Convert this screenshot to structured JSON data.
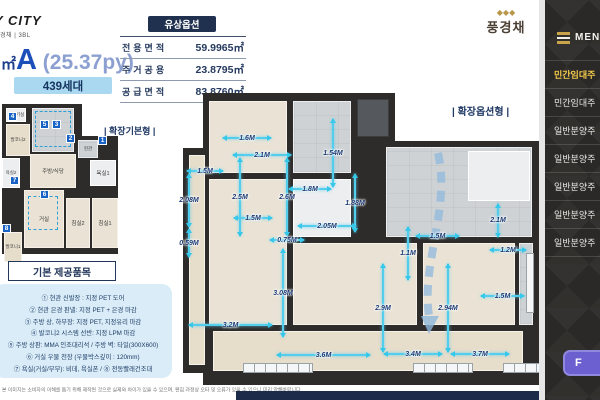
{
  "logo": {
    "brand": "Y CITY",
    "sub": "풍경채 | 3BL"
  },
  "brand_right": {
    "emblem": "◆◆◆",
    "name": "풍경채"
  },
  "header": {
    "unit_area_prefix": "㎡",
    "unit_type": "A",
    "unit_py": " (25.37py)",
    "units_badge": "439세대",
    "option_badge": "유상옵션",
    "area_table": [
      {
        "label": "전용면적",
        "value": "59.9965㎡"
      },
      {
        "label": "주거공용",
        "value": "23.8795㎡"
      },
      {
        "label": "공급면적",
        "value": "83.8760㎡"
      }
    ]
  },
  "plans": {
    "left_label": "| 확장기본형 |",
    "right_label": "| 확장옵션형 |",
    "left_rooms": [
      {
        "name": "실외기실",
        "x": 4,
        "y": 8,
        "w": 20,
        "h": 14,
        "cls": "white r-xs"
      },
      {
        "name": "발코니2",
        "x": 4,
        "y": 24,
        "w": 24,
        "h": 32,
        "cls": "beige2 r-xs"
      },
      {
        "name": "",
        "x": 30,
        "y": 8,
        "w": 42,
        "h": 44,
        "cls": "gray"
      },
      {
        "name": "",
        "x": 33,
        "y": 11,
        "w": 36,
        "h": 36,
        "cls": "dashed"
      },
      {
        "name": "주방/식당",
        "x": 28,
        "y": 54,
        "w": 46,
        "h": 34,
        "cls": "beige r-s"
      },
      {
        "name": "현관",
        "x": 76,
        "y": 40,
        "w": 20,
        "h": 18,
        "cls": "gray r-xs"
      },
      {
        "name": "욕실1",
        "x": 88,
        "y": 60,
        "w": 26,
        "h": 26,
        "cls": "white r-s"
      },
      {
        "name": "욕실2",
        "x": 0,
        "y": 58,
        "w": 18,
        "h": 30,
        "cls": "white r-xs"
      },
      {
        "name": "거실",
        "x": 22,
        "y": 90,
        "w": 40,
        "h": 58,
        "cls": "beige r-s"
      },
      {
        "name": "",
        "x": 26,
        "y": 96,
        "w": 30,
        "h": 34,
        "cls": "dashed"
      },
      {
        "name": "침실2",
        "x": 64,
        "y": 98,
        "w": 24,
        "h": 50,
        "cls": "beige r-s"
      },
      {
        "name": "침실1",
        "x": 90,
        "y": 98,
        "w": 26,
        "h": 50,
        "cls": "beige r-s"
      },
      {
        "name": "발코니1",
        "x": 2,
        "y": 132,
        "w": 18,
        "h": 30,
        "cls": "beige2 r-xs"
      }
    ],
    "left_badges": [
      {
        "n": "1",
        "x": 96,
        "y": 36
      },
      {
        "n": "2",
        "x": 64,
        "y": 34
      },
      {
        "n": "3",
        "x": 50,
        "y": 20
      },
      {
        "n": "4",
        "x": 6,
        "y": 12
      },
      {
        "n": "5",
        "x": 38,
        "y": 20
      },
      {
        "n": "6",
        "x": 38,
        "y": 90
      },
      {
        "n": "7",
        "x": 8,
        "y": 76
      },
      {
        "n": "8",
        "x": 0,
        "y": 124
      }
    ],
    "right_rooms": [
      {
        "x": 26,
        "y": 8,
        "w": 78,
        "h": 72,
        "cls": "beige"
      },
      {
        "x": 110,
        "y": 8,
        "w": 58,
        "h": 72,
        "cls": "gray"
      },
      {
        "x": 174,
        "y": 6,
        "w": 32,
        "h": 38,
        "cls": "dark2"
      },
      {
        "x": 26,
        "y": 86,
        "w": 78,
        "h": 146,
        "cls": "beige"
      },
      {
        "x": 110,
        "y": 86,
        "w": 58,
        "h": 58,
        "cls": "white"
      },
      {
        "x": 203,
        "y": 54,
        "w": 146,
        "h": 90,
        "cls": "gray"
      },
      {
        "x": 285,
        "y": 58,
        "w": 62,
        "h": 50,
        "cls": "white"
      },
      {
        "x": 110,
        "y": 150,
        "w": 124,
        "h": 82,
        "cls": "beige"
      },
      {
        "x": 240,
        "y": 150,
        "w": 92,
        "h": 82,
        "cls": "beige"
      },
      {
        "x": 336,
        "y": 150,
        "w": 14,
        "h": 82,
        "cls": "gray"
      },
      {
        "x": 30,
        "y": 238,
        "w": 310,
        "h": 40,
        "cls": "beige2"
      },
      {
        "x": 6,
        "y": 62,
        "w": 16,
        "h": 210,
        "cls": "beige2"
      },
      {
        "x": 60,
        "y": 270,
        "w": 70,
        "h": 10,
        "cls": "window"
      },
      {
        "x": 230,
        "y": 270,
        "w": 60,
        "h": 10,
        "cls": "window"
      },
      {
        "x": 320,
        "y": 270,
        "w": 40,
        "h": 10,
        "cls": "window"
      },
      {
        "x": 343,
        "y": 160,
        "w": 8,
        "h": 60,
        "cls": "window"
      }
    ],
    "right_dims": [
      {
        "label": "1.6M",
        "x": 39,
        "y": 39,
        "w": 50,
        "h": 12,
        "cls": "h"
      },
      {
        "label": "2.1M",
        "x": 49,
        "y": 56,
        "w": 60,
        "h": 12,
        "cls": "h"
      },
      {
        "label": "1.54M",
        "x": 144,
        "y": 25,
        "w": 12,
        "h": 70,
        "cls": "v"
      },
      {
        "label": "1.5M",
        "x": 3,
        "y": 72,
        "w": 38,
        "h": 12,
        "cls": "h"
      },
      {
        "label": "2.08M",
        "x": 0,
        "y": 80,
        "w": 12,
        "h": 55,
        "cls": "v"
      },
      {
        "label": "0.59M",
        "x": 0,
        "y": 135,
        "w": 12,
        "h": 30,
        "cls": "v"
      },
      {
        "label": "2.5M",
        "x": 51,
        "y": 64,
        "w": 12,
        "h": 80,
        "cls": "v"
      },
      {
        "label": "2.6M",
        "x": 98,
        "y": 64,
        "w": 12,
        "h": 80,
        "cls": "v"
      },
      {
        "label": "1.8M",
        "x": 105,
        "y": 90,
        "w": 44,
        "h": 12,
        "cls": "h"
      },
      {
        "label": "1.5M",
        "x": 50,
        "y": 119,
        "w": 40,
        "h": 12,
        "cls": "h"
      },
      {
        "label": "1.88M",
        "x": 166,
        "y": 80,
        "w": 12,
        "h": 60,
        "cls": "v"
      },
      {
        "label": "2.05M",
        "x": 114,
        "y": 127,
        "w": 60,
        "h": 12,
        "cls": "h"
      },
      {
        "label": "0.75M",
        "x": 86,
        "y": 141,
        "w": 36,
        "h": 12,
        "cls": "h"
      },
      {
        "label": "3.08M",
        "x": 94,
        "y": 155,
        "w": 12,
        "h": 90,
        "cls": "v"
      },
      {
        "label": "3.2M",
        "x": 5,
        "y": 226,
        "w": 85,
        "h": 12,
        "cls": "h"
      },
      {
        "label": "3.6M",
        "x": 93,
        "y": 256,
        "w": 95,
        "h": 12,
        "cls": "h"
      },
      {
        "label": "1.2M",
        "x": 306,
        "y": 151,
        "w": 38,
        "h": 12,
        "cls": "h"
      },
      {
        "label": "1.1M",
        "x": 219,
        "y": 133,
        "w": 12,
        "h": 55,
        "cls": "v"
      },
      {
        "label": "1.5M",
        "x": 297,
        "y": 197,
        "w": 45,
        "h": 12,
        "cls": "h"
      },
      {
        "label": "2.94M",
        "x": 259,
        "y": 170,
        "w": 12,
        "h": 90,
        "cls": "v"
      },
      {
        "label": "2.9M",
        "x": 194,
        "y": 170,
        "w": 12,
        "h": 90,
        "cls": "v"
      },
      {
        "label": "3.4M",
        "x": 200,
        "y": 255,
        "w": 60,
        "h": 12,
        "cls": "h"
      },
      {
        "label": "3.7M",
        "x": 267,
        "y": 255,
        "w": 60,
        "h": 12,
        "cls": "h"
      },
      {
        "label": "1.5M",
        "x": 232,
        "y": 137,
        "w": 45,
        "h": 12,
        "cls": "h"
      },
      {
        "label": "2.1M",
        "x": 309,
        "y": 110,
        "w": 12,
        "h": 35,
        "cls": "v"
      }
    ]
  },
  "provided": {
    "title": "기본 제공품목",
    "items": [
      "① 현관 신발장 : 지정 PET 도어",
      "② 현관 은경 판넬: 지정 PET + 은경 마감",
      "③ 주방 상, 하부장: 지정 PET, 지정유리 마감",
      "④ 발코니2 시스템 선반: 지정 LPM 마감",
      "⑤ 주방 상판: MMA 인조대리석 / 주방 벽: 타일(300X600)",
      "⑥ 거실 우물 천장 (우물박스깊이 : 120mm)",
      "⑦ 욕실(거실/부부): 비데, 욕실폰 / ⑧ 전동빨래건조대"
    ]
  },
  "footer": {
    "disclaimer": "본 이미지는 소비자의 이해를 돕기 위해 제작된 것으로 실제와 차이가 있을 수 있으며, 편집 과정상 오타 및 오류가 있을 수 있으니 미리 양해바랍니다."
  },
  "sidebar": {
    "menu_label": "MENU",
    "items": [
      {
        "label": "민간임대주",
        "cls": "active"
      },
      {
        "label": "민간임대주"
      },
      {
        "label": "일반분양주"
      },
      {
        "label": "일반분양주"
      },
      {
        "label": "일반분양주"
      },
      {
        "label": "일반분양주"
      },
      {
        "label": "일반분양주"
      }
    ],
    "button_label": "F"
  }
}
